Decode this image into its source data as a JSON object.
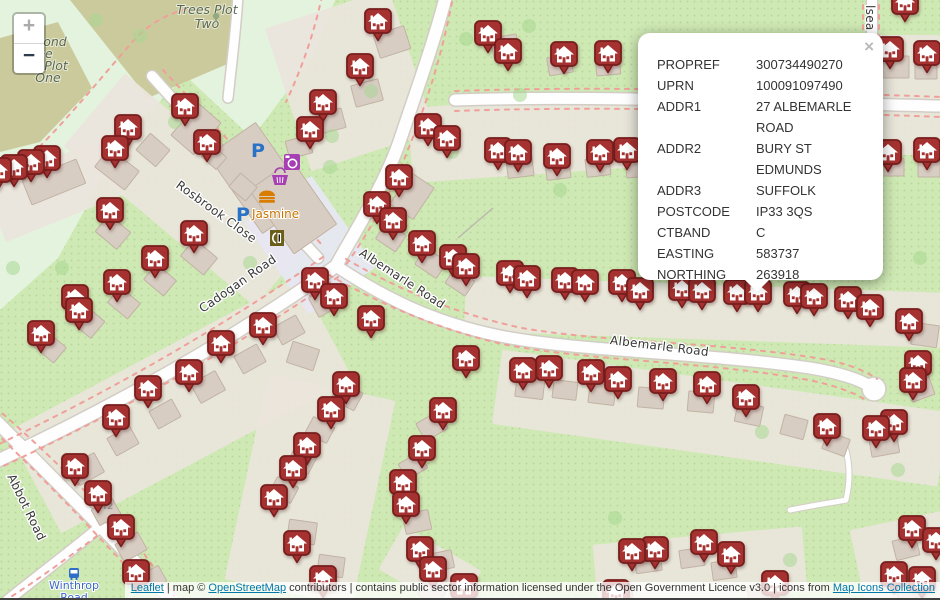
{
  "controls": {
    "zoom_in": "+",
    "zoom_out": "−"
  },
  "popup": {
    "close": "×",
    "rows": [
      {
        "label": "PROPREF",
        "value": "300734490270"
      },
      {
        "label": "UPRN",
        "value": "100091097490"
      },
      {
        "label": "ADDR1",
        "value": "27 ALBEMARLE ROAD"
      },
      {
        "label": "ADDR2",
        "value": "BURY ST EDMUNDS"
      },
      {
        "label": "ADDR3",
        "value": "SUFFOLK"
      },
      {
        "label": "POSTCODE",
        "value": "IP33 3QS"
      },
      {
        "label": "CTBAND",
        "value": "C"
      },
      {
        "label": "EASTING",
        "value": "583737"
      },
      {
        "label": "NORTHING",
        "value": "263918"
      }
    ]
  },
  "attribution": {
    "leaflet_label": "Leaflet",
    "after_leaflet": " | map © ",
    "osm_label": "OpenStreetMap",
    "after_osm": " contributors | contains public sector information licensed under the Open Government Licence v3.0 | icons from ",
    "icons_label": "Map Icons Collection"
  },
  "map": {
    "colors": {
      "marker_fill": "#a53231",
      "marker_stroke": "#771d1c",
      "dash": "#f0a09a",
      "link": "#0078a8",
      "parking_blue": "#2a72c8",
      "shop_purple": "#a63fb3",
      "food_orange": "#d87d00"
    },
    "markers": [
      [
        905,
        2
      ],
      [
        378,
        21
      ],
      [
        488,
        33
      ],
      [
        890,
        49
      ],
      [
        508,
        51
      ],
      [
        927,
        53
      ],
      [
        564,
        54
      ],
      [
        608,
        53
      ],
      [
        360,
        66
      ],
      [
        323,
        102
      ],
      [
        185,
        106
      ],
      [
        428,
        126
      ],
      [
        128,
        127
      ],
      [
        310,
        129
      ],
      [
        447,
        138
      ],
      [
        207,
        142
      ],
      [
        115,
        148
      ],
      [
        498,
        150
      ],
      [
        627,
        150
      ],
      [
        927,
        150
      ],
      [
        518,
        152
      ],
      [
        888,
        152
      ],
      [
        557,
        156
      ],
      [
        600,
        152
      ],
      [
        47,
        158
      ],
      [
        31,
        162
      ],
      [
        14,
        167
      ],
      [
        -2,
        170
      ],
      [
        399,
        177
      ],
      [
        377,
        204
      ],
      [
        393,
        220
      ],
      [
        110,
        210
      ],
      [
        194,
        233
      ],
      [
        422,
        243
      ],
      [
        453,
        257
      ],
      [
        155,
        258
      ],
      [
        466,
        266
      ],
      [
        510,
        273
      ],
      [
        527,
        278
      ],
      [
        117,
        282
      ],
      [
        315,
        280
      ],
      [
        585,
        282
      ],
      [
        565,
        280
      ],
      [
        622,
        282
      ],
      [
        682,
        288
      ],
      [
        640,
        290
      ],
      [
        702,
        290
      ],
      [
        737,
        292
      ],
      [
        758,
        292
      ],
      [
        797,
        294
      ],
      [
        814,
        296
      ],
      [
        334,
        296
      ],
      [
        75,
        297
      ],
      [
        848,
        299
      ],
      [
        870,
        307
      ],
      [
        79,
        310
      ],
      [
        371,
        318
      ],
      [
        909,
        321
      ],
      [
        263,
        325
      ],
      [
        41,
        333
      ],
      [
        221,
        343
      ],
      [
        466,
        358
      ],
      [
        918,
        363
      ],
      [
        549,
        368
      ],
      [
        523,
        370
      ],
      [
        189,
        372
      ],
      [
        591,
        372
      ],
      [
        618,
        379
      ],
      [
        913,
        380
      ],
      [
        663,
        381
      ],
      [
        346,
        384
      ],
      [
        707,
        384
      ],
      [
        148,
        388
      ],
      [
        746,
        397
      ],
      [
        331,
        409
      ],
      [
        443,
        410
      ],
      [
        116,
        417
      ],
      [
        894,
        422
      ],
      [
        827,
        426
      ],
      [
        876,
        428
      ],
      [
        307,
        445
      ],
      [
        422,
        448
      ],
      [
        75,
        466
      ],
      [
        293,
        468
      ],
      [
        403,
        482
      ],
      [
        98,
        493
      ],
      [
        274,
        497
      ],
      [
        406,
        504
      ],
      [
        121,
        527
      ],
      [
        912,
        528
      ],
      [
        936,
        540
      ],
      [
        704,
        542
      ],
      [
        297,
        543
      ],
      [
        655,
        549
      ],
      [
        420,
        549
      ],
      [
        632,
        551
      ],
      [
        731,
        554
      ],
      [
        433,
        569
      ],
      [
        136,
        572
      ],
      [
        323,
        578
      ],
      [
        775,
        583
      ],
      [
        894,
        574
      ],
      [
        922,
        579
      ],
      [
        464,
        586
      ],
      [
        616,
        592
      ]
    ],
    "buildings": [
      [
        259,
        178,
        58,
        95,
        -35
      ],
      [
        293,
        207,
        52,
        78,
        -35
      ],
      [
        392,
        42,
        32,
        24,
        -18
      ],
      [
        367,
        93,
        28,
        22,
        -15
      ],
      [
        331,
        121,
        26,
        20,
        -15
      ],
      [
        299,
        147,
        24,
        18,
        -15
      ],
      [
        196,
        129,
        30,
        42,
        41
      ],
      [
        153,
        150,
        26,
        22,
        41
      ],
      [
        117,
        169,
        38,
        24,
        38
      ],
      [
        54,
        182,
        58,
        26,
        -22
      ],
      [
        214,
        157,
        20,
        16,
        41
      ],
      [
        243,
        187,
        22,
        18,
        41
      ],
      [
        113,
        232,
        28,
        22,
        40
      ],
      [
        199,
        257,
        30,
        22,
        40
      ],
      [
        160,
        280,
        26,
        20,
        40
      ],
      [
        124,
        303,
        26,
        20,
        40
      ],
      [
        87,
        321,
        28,
        22,
        40
      ],
      [
        50,
        347,
        26,
        20,
        40
      ],
      [
        412,
        196,
        28,
        38,
        34
      ],
      [
        391,
        237,
        24,
        20,
        34
      ],
      [
        431,
        263,
        26,
        20,
        34
      ],
      [
        460,
        282,
        24,
        18,
        34
      ],
      [
        326,
        301,
        28,
        22,
        -29
      ],
      [
        289,
        330,
        26,
        20,
        -29
      ],
      [
        250,
        359,
        26,
        20,
        -29
      ],
      [
        208,
        387,
        28,
        22,
        -29
      ],
      [
        165,
        414,
        26,
        20,
        -29
      ],
      [
        123,
        441,
        26,
        20,
        -29
      ],
      [
        87,
        469,
        28,
        22,
        -29
      ],
      [
        106,
        512,
        24,
        18,
        -29
      ],
      [
        131,
        547,
        26,
        20,
        -29
      ],
      [
        152,
        579,
        24,
        18,
        -29
      ],
      [
        303,
        356,
        28,
        22,
        18
      ],
      [
        347,
        396,
        26,
        20,
        28
      ],
      [
        320,
        430,
        24,
        18,
        28
      ],
      [
        302,
        460,
        24,
        20,
        28
      ],
      [
        284,
        490,
        24,
        18,
        28
      ],
      [
        302,
        532,
        28,
        22,
        8
      ],
      [
        331,
        566,
        26,
        20,
        8
      ],
      [
        432,
        426,
        26,
        20,
        -30
      ],
      [
        413,
        466,
        24,
        18,
        -30
      ],
      [
        417,
        522,
        26,
        20,
        -12
      ],
      [
        441,
        561,
        24,
        18,
        -12
      ],
      [
        530,
        387,
        28,
        22,
        7
      ],
      [
        565,
        390,
        24,
        18,
        7
      ],
      [
        602,
        394,
        26,
        20,
        7
      ],
      [
        651,
        398,
        26,
        20,
        5
      ],
      [
        701,
        402,
        26,
        20,
        5
      ],
      [
        749,
        414,
        26,
        20,
        12
      ],
      [
        794,
        427,
        24,
        20,
        15
      ],
      [
        836,
        444,
        24,
        18,
        20
      ],
      [
        884,
        444,
        28,
        22,
        -10
      ],
      [
        919,
        385,
        24,
        28,
        -20
      ],
      [
        925,
        335,
        26,
        22,
        8
      ],
      [
        520,
        167,
        26,
        20,
        -7
      ],
      [
        558,
        170,
        24,
        18,
        -7
      ],
      [
        598,
        167,
        24,
        18,
        -7
      ],
      [
        638,
        168,
        24,
        18,
        -5
      ],
      [
        505,
        46,
        26,
        20,
        -10
      ],
      [
        560,
        65,
        24,
        18,
        -10
      ],
      [
        608,
        66,
        24,
        18,
        -5
      ],
      [
        896,
        67,
        26,
        22,
        0
      ],
      [
        926,
        70,
        22,
        18,
        0
      ],
      [
        929,
        167,
        22,
        20,
        0
      ],
      [
        894,
        167,
        20,
        18,
        0
      ],
      [
        648,
        562,
        26,
        20,
        -8
      ],
      [
        692,
        558,
        24,
        18,
        -8
      ],
      [
        724,
        570,
        24,
        18,
        -8
      ],
      [
        760,
        594,
        24,
        18,
        -8
      ],
      [
        906,
        548,
        24,
        20,
        -14
      ],
      [
        908,
        590,
        22,
        18,
        -14
      ],
      [
        432,
        592,
        24,
        18,
        28
      ],
      [
        622,
        598,
        22,
        16,
        -8
      ]
    ],
    "patches": [
      [
        190,
        190,
        250,
        95,
        40
      ],
      [
        350,
        80,
        130,
        150,
        -18
      ],
      [
        55,
        190,
        130,
        60,
        -22
      ],
      [
        560,
        135,
        300,
        75,
        -4
      ],
      [
        705,
        312,
        480,
        55,
        2
      ],
      [
        720,
        418,
        450,
        75,
        8
      ],
      [
        180,
        405,
        330,
        115,
        -28
      ],
      [
        310,
        490,
        130,
        210,
        12
      ],
      [
        700,
        568,
        210,
        65,
        -5
      ],
      [
        905,
        562,
        95,
        85,
        -12
      ],
      [
        905,
        95,
        70,
        120,
        0
      ],
      [
        430,
        570,
        90,
        50,
        30
      ],
      [
        310,
        245,
        82,
        112,
        -35,
        "#e7e7f3"
      ]
    ],
    "trees": [
      [
        332,
        136
      ],
      [
        371,
        91
      ],
      [
        466,
        39
      ],
      [
        529,
        26
      ],
      [
        452,
        152
      ],
      [
        560,
        190
      ],
      [
        920,
        258
      ],
      [
        898,
        470
      ],
      [
        762,
        432
      ],
      [
        615,
        518
      ],
      [
        250,
        263
      ],
      [
        175,
        122
      ],
      [
        62,
        268
      ],
      [
        680,
        93
      ],
      [
        860,
        250
      ],
      [
        330,
        167
      ],
      [
        13,
        268
      ],
      [
        96,
        20
      ],
      [
        140,
        36
      ],
      [
        790,
        560
      ],
      [
        520,
        95
      ]
    ],
    "road_labels": [
      {
        "text": "Rosbrook Close",
        "x": 214,
        "y": 215,
        "rot": 36
      },
      {
        "text": "Cadogan Road",
        "x": 240,
        "y": 287,
        "rot": -35
      },
      {
        "text": "Albemarle Road",
        "x": 400,
        "y": 282,
        "rot": 33
      },
      {
        "text": "Albemarle Road",
        "x": 659,
        "y": 350,
        "rot": 7
      },
      {
        "text": "Abbot Road",
        "x": 23,
        "y": 509,
        "rot": 64
      },
      {
        "text": "lsea Cl",
        "x": 866,
        "y": 26,
        "rot": 90
      }
    ],
    "area_labels": [
      {
        "text": "Trees Plot",
        "x": 207,
        "y": 14
      },
      {
        "text": "Two",
        "x": 207,
        "y": 28
      },
      {
        "text": "ond",
        "x": 55,
        "y": 46
      },
      {
        "text": "ee",
        "x": 45,
        "y": 58
      },
      {
        "text": "Plot",
        "x": 56,
        "y": 70
      },
      {
        "text": "One",
        "x": 48,
        "y": 82
      }
    ],
    "house_numbers": [
      {
        "text": "42",
        "x": 107,
        "y": 509
      }
    ],
    "bus_stop": {
      "line1": "Winthrop",
      "line2": "Road",
      "x": 74,
      "y": 589
    },
    "poi": {
      "parking_label": "P",
      "restaurant_name": "Jasmine"
    }
  }
}
